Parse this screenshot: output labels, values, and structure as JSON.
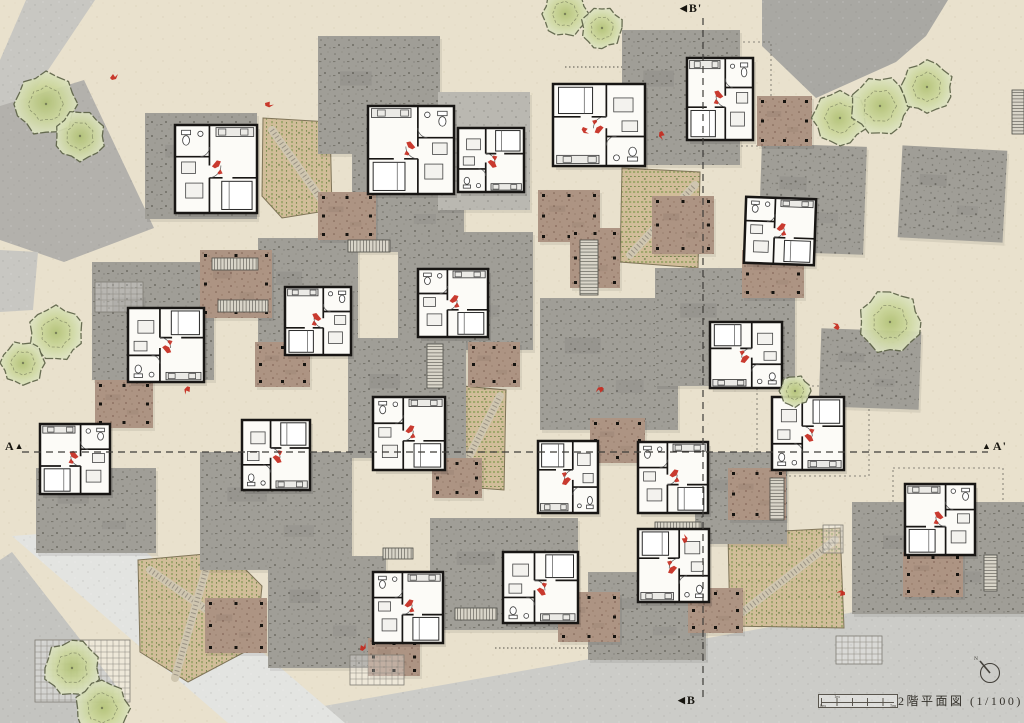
{
  "title_block": {
    "title": "2階平面図 (1/100)",
    "north_label": "N",
    "scale_bar": {
      "labels": [
        "0m",
        "1m",
        "5m"
      ]
    }
  },
  "section_markers": {
    "a": "A",
    "a_prime": "A'",
    "b": "B",
    "b_prime": "B'"
  },
  "colors": {
    "ground": "#e9e1cd",
    "roof_gray": "#a09e97",
    "roof_gray_light": "#bab8b1",
    "terrace_brown": "#ad9483",
    "plan_floor": "#fcfbf7",
    "wall": "#181614",
    "accent_red": "#c4291d",
    "tree_fill": "#ccd79c",
    "tree_stroke": "#5e6448",
    "field_tan": "#d1bd99",
    "crop_green": "#8fa05e",
    "section_line": "#3e3c38"
  },
  "section_lines": {
    "a": {
      "y": 452,
      "x1": 22,
      "x2": 988
    },
    "b": {
      "x": 703,
      "y1": 18,
      "y2": 697
    }
  },
  "site": {
    "roads": [
      {
        "name": "road-top-left-band",
        "points": [
          [
            26,
            0
          ],
          [
            95,
            0
          ],
          [
            12,
            124
          ],
          [
            0,
            130
          ],
          [
            0,
            60
          ]
        ],
        "fill": "#c8c7c2"
      },
      {
        "name": "plaza-top-left",
        "points": [
          [
            0,
            106
          ],
          [
            84,
            80
          ],
          [
            154,
            228
          ],
          [
            64,
            262
          ],
          [
            0,
            240
          ]
        ],
        "fill": "#b3b1ac"
      },
      {
        "name": "road-left-block",
        "points": [
          [
            0,
            250
          ],
          [
            38,
            252
          ],
          [
            33,
            310
          ],
          [
            0,
            312
          ]
        ],
        "fill": "#c8c7c2"
      },
      {
        "name": "plaza-top-right",
        "points": [
          [
            762,
            0
          ],
          [
            948,
            0
          ],
          [
            926,
            36
          ],
          [
            896,
            62
          ],
          [
            816,
            98
          ],
          [
            762,
            46
          ]
        ],
        "fill": "#a9a8a3"
      },
      {
        "name": "road-bottom",
        "points": [
          [
            228,
            723
          ],
          [
            1024,
            582
          ],
          [
            1024,
            723
          ]
        ],
        "fill": "#ccccc8"
      },
      {
        "name": "path-bottom-left",
        "points": [
          [
            12,
            536
          ],
          [
            118,
            528
          ],
          [
            345,
            723
          ],
          [
            228,
            723
          ]
        ],
        "fill": "#e3e4e1"
      },
      {
        "name": "road-bottom-left",
        "points": [
          [
            0,
            560
          ],
          [
            12,
            552
          ],
          [
            118,
            688
          ],
          [
            80,
            723
          ],
          [
            0,
            723
          ]
        ],
        "fill": "#c4c4c0"
      }
    ],
    "roof_plates": [
      [
        145,
        113,
        112,
        106,
        0,
        0
      ],
      [
        318,
        36,
        122,
        118,
        0,
        0
      ],
      [
        352,
        152,
        112,
        100,
        0,
        0
      ],
      [
        622,
        30,
        118,
        135,
        0,
        0
      ],
      [
        760,
        145,
        105,
        108,
        2,
        0
      ],
      [
        92,
        262,
        122,
        118,
        0,
        0
      ],
      [
        258,
        238,
        100,
        112,
        0,
        0
      ],
      [
        398,
        232,
        135,
        118,
        0,
        0
      ],
      [
        540,
        298,
        138,
        132,
        0,
        0
      ],
      [
        655,
        268,
        140,
        118,
        0,
        0
      ],
      [
        820,
        330,
        100,
        78,
        2,
        0
      ],
      [
        200,
        452,
        152,
        118,
        0,
        0
      ],
      [
        348,
        338,
        118,
        120,
        0,
        0
      ],
      [
        36,
        468,
        120,
        85,
        0,
        0
      ],
      [
        430,
        518,
        148,
        112,
        0,
        0
      ],
      [
        588,
        572,
        118,
        88,
        0,
        0
      ],
      [
        852,
        502,
        172,
        112,
        0,
        0
      ],
      [
        268,
        556,
        118,
        112,
        0,
        0
      ],
      [
        695,
        452,
        92,
        92,
        0,
        0
      ],
      [
        900,
        148,
        105,
        92,
        3,
        0
      ],
      [
        438,
        92,
        92,
        118,
        0,
        1
      ]
    ],
    "terrace_plates": [
      [
        200,
        250,
        72,
        68
      ],
      [
        318,
        192,
        58,
        48
      ],
      [
        538,
        190,
        62,
        52
      ],
      [
        652,
        196,
        62,
        58
      ],
      [
        742,
        250,
        62,
        48
      ],
      [
        757,
        96,
        55,
        50
      ],
      [
        95,
        380,
        58,
        48
      ],
      [
        255,
        342,
        55,
        45
      ],
      [
        468,
        342,
        52,
        45
      ],
      [
        590,
        418,
        55,
        45
      ],
      [
        728,
        468,
        58,
        52
      ],
      [
        558,
        592,
        62,
        50
      ],
      [
        432,
        458,
        50,
        40
      ],
      [
        688,
        588,
        55,
        45
      ],
      [
        903,
        552,
        60,
        45
      ],
      [
        205,
        598,
        62,
        55
      ],
      [
        368,
        638,
        52,
        38
      ],
      [
        570,
        228,
        50,
        60
      ]
    ],
    "gardens": [
      {
        "points": [
          [
            263,
            118
          ],
          [
            330,
            122
          ],
          [
            332,
            210
          ],
          [
            282,
            218
          ],
          [
            262,
            196
          ]
        ],
        "rows": "v",
        "path": [
          272,
          130,
          326,
          206
        ]
      },
      {
        "points": [
          [
            622,
            168
          ],
          [
            700,
            172
          ],
          [
            698,
            268
          ],
          [
            620,
            262
          ]
        ],
        "rows": "h",
        "path": [
          630,
          255,
          695,
          185
        ]
      },
      {
        "points": [
          [
            452,
            385
          ],
          [
            506,
            390
          ],
          [
            504,
            490
          ],
          [
            452,
            486
          ]
        ],
        "rows": "h",
        "path": [
          458,
          478,
          500,
          396
        ]
      },
      {
        "points": [
          [
            138,
            560
          ],
          [
            228,
            552
          ],
          [
            262,
            586
          ],
          [
            256,
            646
          ],
          [
            188,
            682
          ],
          [
            140,
            652
          ]
        ],
        "rows": "v",
        "path": [
          150,
          570,
          250,
          640
        ],
        "path2": [
          210,
          555,
          175,
          678
        ]
      },
      {
        "points": [
          [
            728,
            534
          ],
          [
            840,
            528
          ],
          [
            844,
            628
          ],
          [
            730,
            626
          ]
        ],
        "rows": "v",
        "path": [
          735,
          618,
          835,
          540
        ]
      }
    ],
    "trees": [
      [
        46,
        104,
        30
      ],
      [
        80,
        136,
        24
      ],
      [
        565,
        14,
        22
      ],
      [
        602,
        28,
        20
      ],
      [
        840,
        118,
        26
      ],
      [
        880,
        106,
        28
      ],
      [
        927,
        87,
        25
      ],
      [
        890,
        322,
        30
      ],
      [
        795,
        391,
        15
      ],
      [
        56,
        333,
        26
      ],
      [
        23,
        363,
        21
      ],
      [
        72,
        668,
        27
      ],
      [
        102,
        708,
        26
      ]
    ],
    "stairs": [
      [
        212,
        258,
        46,
        12
      ],
      [
        218,
        300,
        50,
        12
      ],
      [
        348,
        240,
        42,
        12
      ],
      [
        427,
        344,
        16,
        44
      ],
      [
        580,
        240,
        18,
        55
      ],
      [
        770,
        478,
        14,
        42
      ],
      [
        655,
        522,
        46,
        12
      ],
      [
        455,
        608,
        42,
        12
      ],
      [
        383,
        548,
        30,
        11
      ],
      [
        984,
        555,
        13,
        36
      ],
      [
        1012,
        90,
        12,
        44
      ]
    ],
    "trellis": [
      [
        350,
        655,
        54,
        30
      ],
      [
        35,
        640,
        95,
        62
      ],
      [
        836,
        636,
        46,
        28
      ],
      [
        95,
        282,
        48,
        30
      ],
      [
        823,
        525,
        20,
        28
      ]
    ],
    "guide_rects": [
      [
        683,
        42,
        88,
        104
      ],
      [
        757,
        386,
        112,
        90
      ],
      [
        893,
        468,
        110,
        92
      ]
    ],
    "guide_lines": [
      [
        495,
        648,
        643,
        648
      ],
      [
        565,
        67,
        645,
        67
      ]
    ],
    "red_marks": [
      [
        110,
        78
      ],
      [
        265,
        103
      ],
      [
        583,
        127
      ],
      [
        662,
        131
      ],
      [
        190,
        387
      ],
      [
        604,
        389
      ],
      [
        845,
        595
      ],
      [
        838,
        330
      ],
      [
        684,
        543
      ],
      [
        360,
        650
      ]
    ]
  },
  "units": [
    [
      175,
      125,
      82,
      88,
      0,
      0
    ],
    [
      368,
      106,
      86,
      88,
      0,
      1
    ],
    [
      458,
      128,
      66,
      64,
      0,
      2
    ],
    [
      553,
      84,
      92,
      82,
      0,
      3
    ],
    [
      687,
      58,
      66,
      82,
      0,
      1
    ],
    [
      745,
      198,
      70,
      66,
      2,
      0
    ],
    [
      128,
      308,
      76,
      74,
      0,
      2
    ],
    [
      285,
      287,
      66,
      68,
      0,
      1
    ],
    [
      418,
      269,
      70,
      68,
      0,
      0
    ],
    [
      710,
      322,
      72,
      66,
      0,
      3
    ],
    [
      40,
      424,
      70,
      70,
      0,
      1
    ],
    [
      242,
      420,
      68,
      70,
      0,
      2
    ],
    [
      373,
      397,
      72,
      73,
      0,
      0
    ],
    [
      538,
      441,
      60,
      72,
      0,
      3
    ],
    [
      638,
      442,
      70,
      71,
      0,
      0
    ],
    [
      772,
      397,
      72,
      73,
      0,
      2
    ],
    [
      905,
      484,
      70,
      71,
      0,
      1
    ],
    [
      373,
      572,
      70,
      71,
      0,
      0
    ],
    [
      503,
      552,
      75,
      71,
      0,
      2
    ],
    [
      638,
      529,
      71,
      73,
      0,
      3
    ]
  ]
}
